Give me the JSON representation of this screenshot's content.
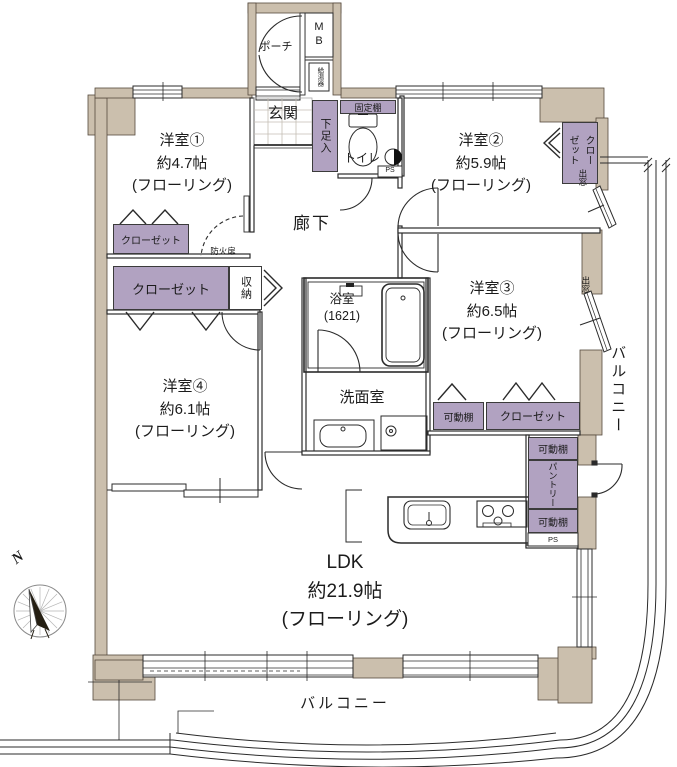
{
  "colors": {
    "wall": "#cbbfad",
    "storage": "#b1a2c1",
    "line": "#2b2b2b"
  },
  "compass": {
    "north_label": "N"
  },
  "rooms": [
    {
      "name": "洋室①",
      "size": "約4.7帖",
      "floor": "(フローリング)"
    },
    {
      "name": "洋室②",
      "size": "約5.9帖",
      "floor": "(フローリング)"
    },
    {
      "name": "洋室③",
      "size": "約6.5帖",
      "floor": "(フローリング)"
    },
    {
      "name": "洋室④",
      "size": "約6.1帖",
      "floor": "(フローリング)"
    },
    {
      "name": "LDK",
      "size": "約21.9帖",
      "floor": "(フローリング)"
    }
  ],
  "labels": {
    "porch": "ポーチ",
    "meter_box": "MB",
    "water_heater": "給湯器",
    "entrance": "玄関",
    "shoe_cabinet": "下足入",
    "fixed_shelf": "固定棚",
    "toilet": "トイレ",
    "pipe_space": "PS",
    "hallway": "廊下",
    "fire_door": "防火扉",
    "closet": "クローゼット",
    "storage": "収納",
    "bath": "浴室",
    "bath_size": "(1621)",
    "washroom": "洗面室",
    "movable_shelf": "可動棚",
    "pantry": "パントリー",
    "bay_window": "出窓",
    "balcony": "バルコニー"
  }
}
